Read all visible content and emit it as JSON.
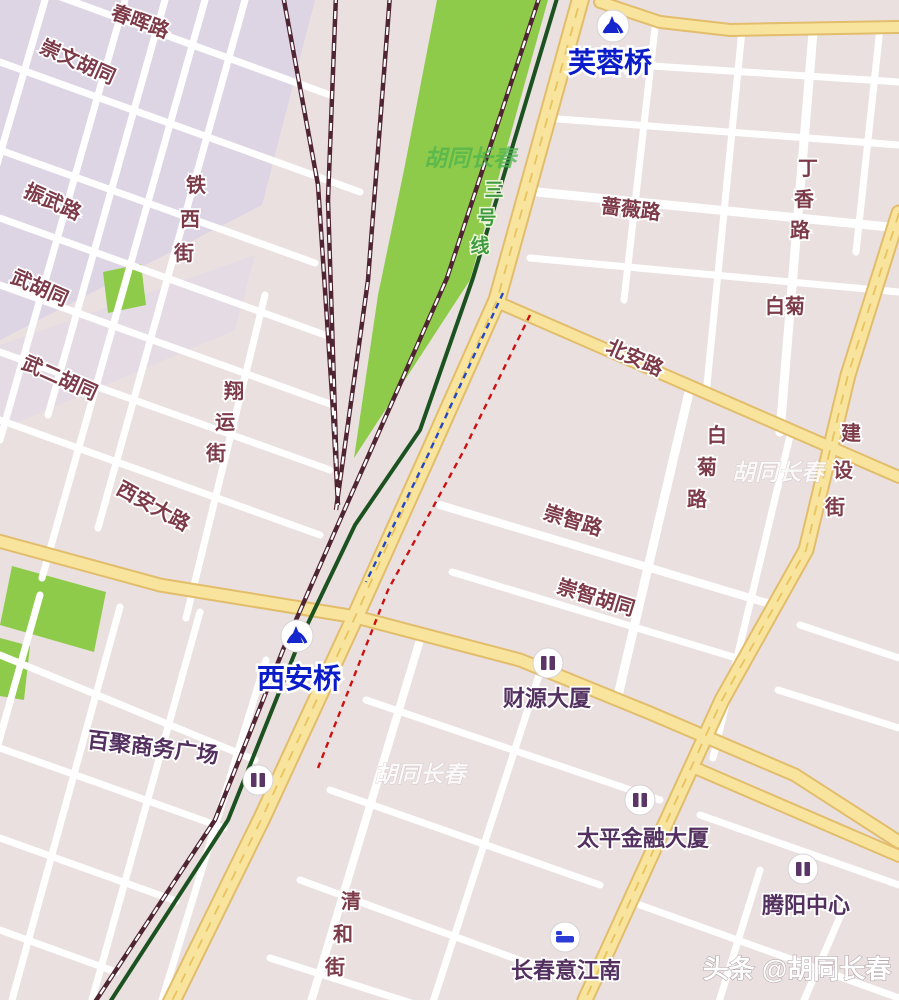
{
  "map": {
    "bridges": {
      "furong": "芙蓉桥",
      "xian": "西安桥"
    },
    "subway_line": "三号线",
    "roads": {
      "chunhui": "春晖路",
      "chongwen": "崇文胡同",
      "zhenwu": "振武路",
      "wuhutong": "武胡同",
      "wuer": "武二胡同",
      "tiexi": "铁西街",
      "xiangyun": "翔运街",
      "xianda": "西安大路",
      "beian": "北安路",
      "qiangwei": "蔷薇路",
      "dingxiang": "丁香路",
      "baiju": "白菊",
      "baijulu": "白菊路",
      "jianshe": "建设街",
      "chongzhi": "崇智路",
      "chongzhihutong": "崇智胡同",
      "qinghe": "清和街"
    },
    "pois": {
      "baiju_plaza": "百聚商务广场",
      "caiyuan": "财源大厦",
      "taiping": "太平金融大厦",
      "tengyang": "腾阳中心",
      "yijiangnan": "长春意江南"
    },
    "watermarks": {
      "w1": "胡同长春",
      "w2": "胡同长春",
      "w3": "胡同长春",
      "byline": "头条 @胡同长春"
    },
    "colors": {
      "land": "#eae0e0",
      "block_lavender": "#ddd4e4",
      "park_green": "#8fcb4a",
      "road_minor": "#ffffff",
      "road_major_fill": "#f8e49c",
      "road_major_edge": "#e2bd6b",
      "railway": "#4f2433",
      "subway_line3": "#1b5220",
      "dash_red": "#cc1111",
      "dash_blue": "#2247cc",
      "label_road": "#7d3b49",
      "label_poi": "#53305f",
      "label_bridge": "#0b1cc9"
    }
  }
}
